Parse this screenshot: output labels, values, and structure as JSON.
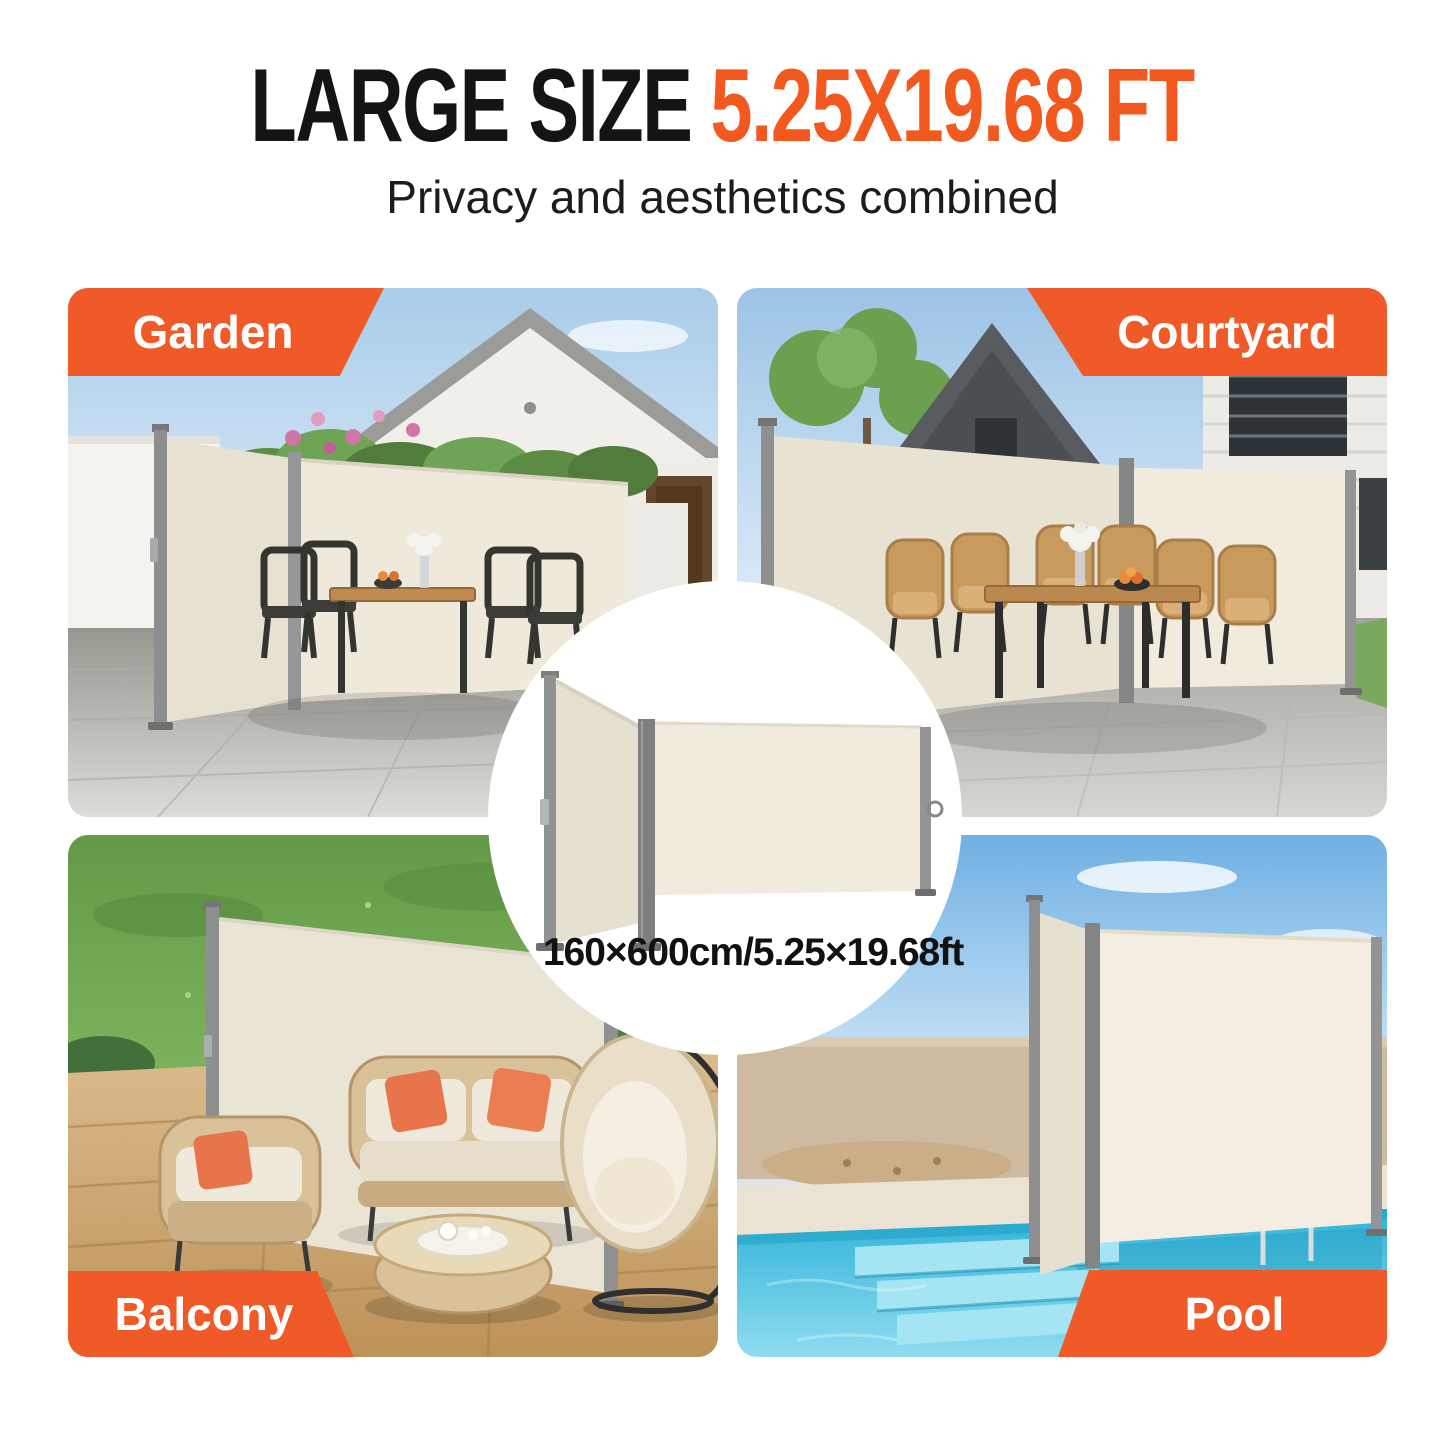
{
  "header": {
    "title_black": "LARGE SIZE",
    "title_orange": "5.25X19.68 FT",
    "subtitle": "Privacy and aesthetics combined"
  },
  "quadrants": [
    {
      "id": "garden",
      "label": "Garden",
      "corner": "top-left"
    },
    {
      "id": "courtyard",
      "label": "Courtyard",
      "corner": "top-right"
    },
    {
      "id": "balcony",
      "label": "Balcony",
      "corner": "bottom-left"
    },
    {
      "id": "pool",
      "label": "Pool",
      "corner": "bottom-right"
    }
  ],
  "center_badge": {
    "dimension_text": "160×600cm/5.25×19.68ft"
  },
  "colors": {
    "accent_orange": "#F05A28",
    "title_orange": "#F1591F",
    "text_black": "#141414",
    "awning_fabric": "#EFE9DB",
    "pole_gray": "#8E8E8E"
  }
}
